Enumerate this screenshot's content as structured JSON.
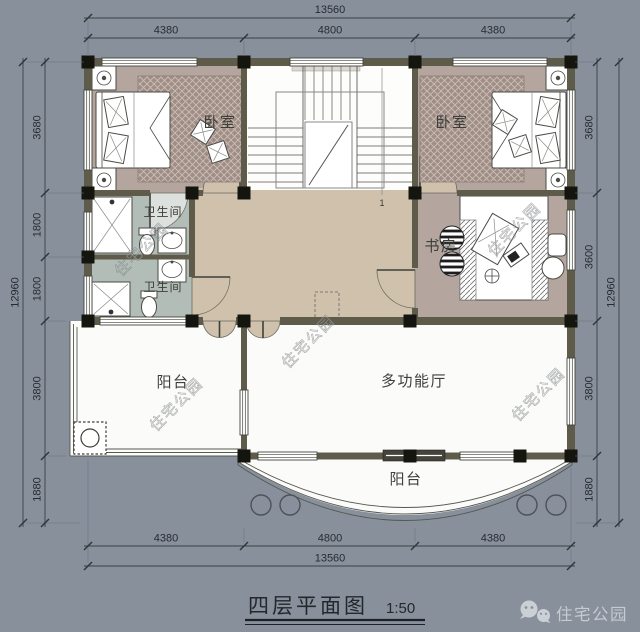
{
  "title": {
    "text": "四层平面图",
    "scale": "1:50"
  },
  "badge": {
    "label": "住宅公园"
  },
  "watermark": {
    "text": "住宅公园"
  },
  "stairs": {
    "mark": "1"
  },
  "rooms": {
    "bedroom_left": "卧室",
    "bedroom_right": "卧室",
    "bathroom_upper": "卫生间",
    "bathroom_lower": "卫生间",
    "study": "书房",
    "multi_hall": "多功能厅",
    "balcony_left": "阳台",
    "balcony_bottom": "阳台"
  },
  "dimensions": {
    "top": {
      "total": "13560",
      "segments": [
        "4380",
        "4800",
        "4380"
      ]
    },
    "bottom": {
      "total": "13560",
      "segments": [
        "4380",
        "4800",
        "4380"
      ]
    },
    "left": {
      "total": "12960",
      "segments": [
        "3680",
        "1800",
        "1800",
        "3800",
        "1880"
      ]
    },
    "right": {
      "total": "12960",
      "segments": [
        "3680",
        "3600",
        "3800",
        "1880"
      ]
    }
  },
  "colors": {
    "background": "#87909b",
    "wall": "#5f5b4a",
    "column": "#15150f",
    "bedroom_floor": "#b4a59e",
    "carpet": "#a08e86",
    "bathroom_floor": "#b2bdb7",
    "corridor_floor": "#cfc1ac",
    "white_floor": "#fbfbfa",
    "dim_text": "#272c31",
    "badge_gray": "#c6cbd1"
  }
}
